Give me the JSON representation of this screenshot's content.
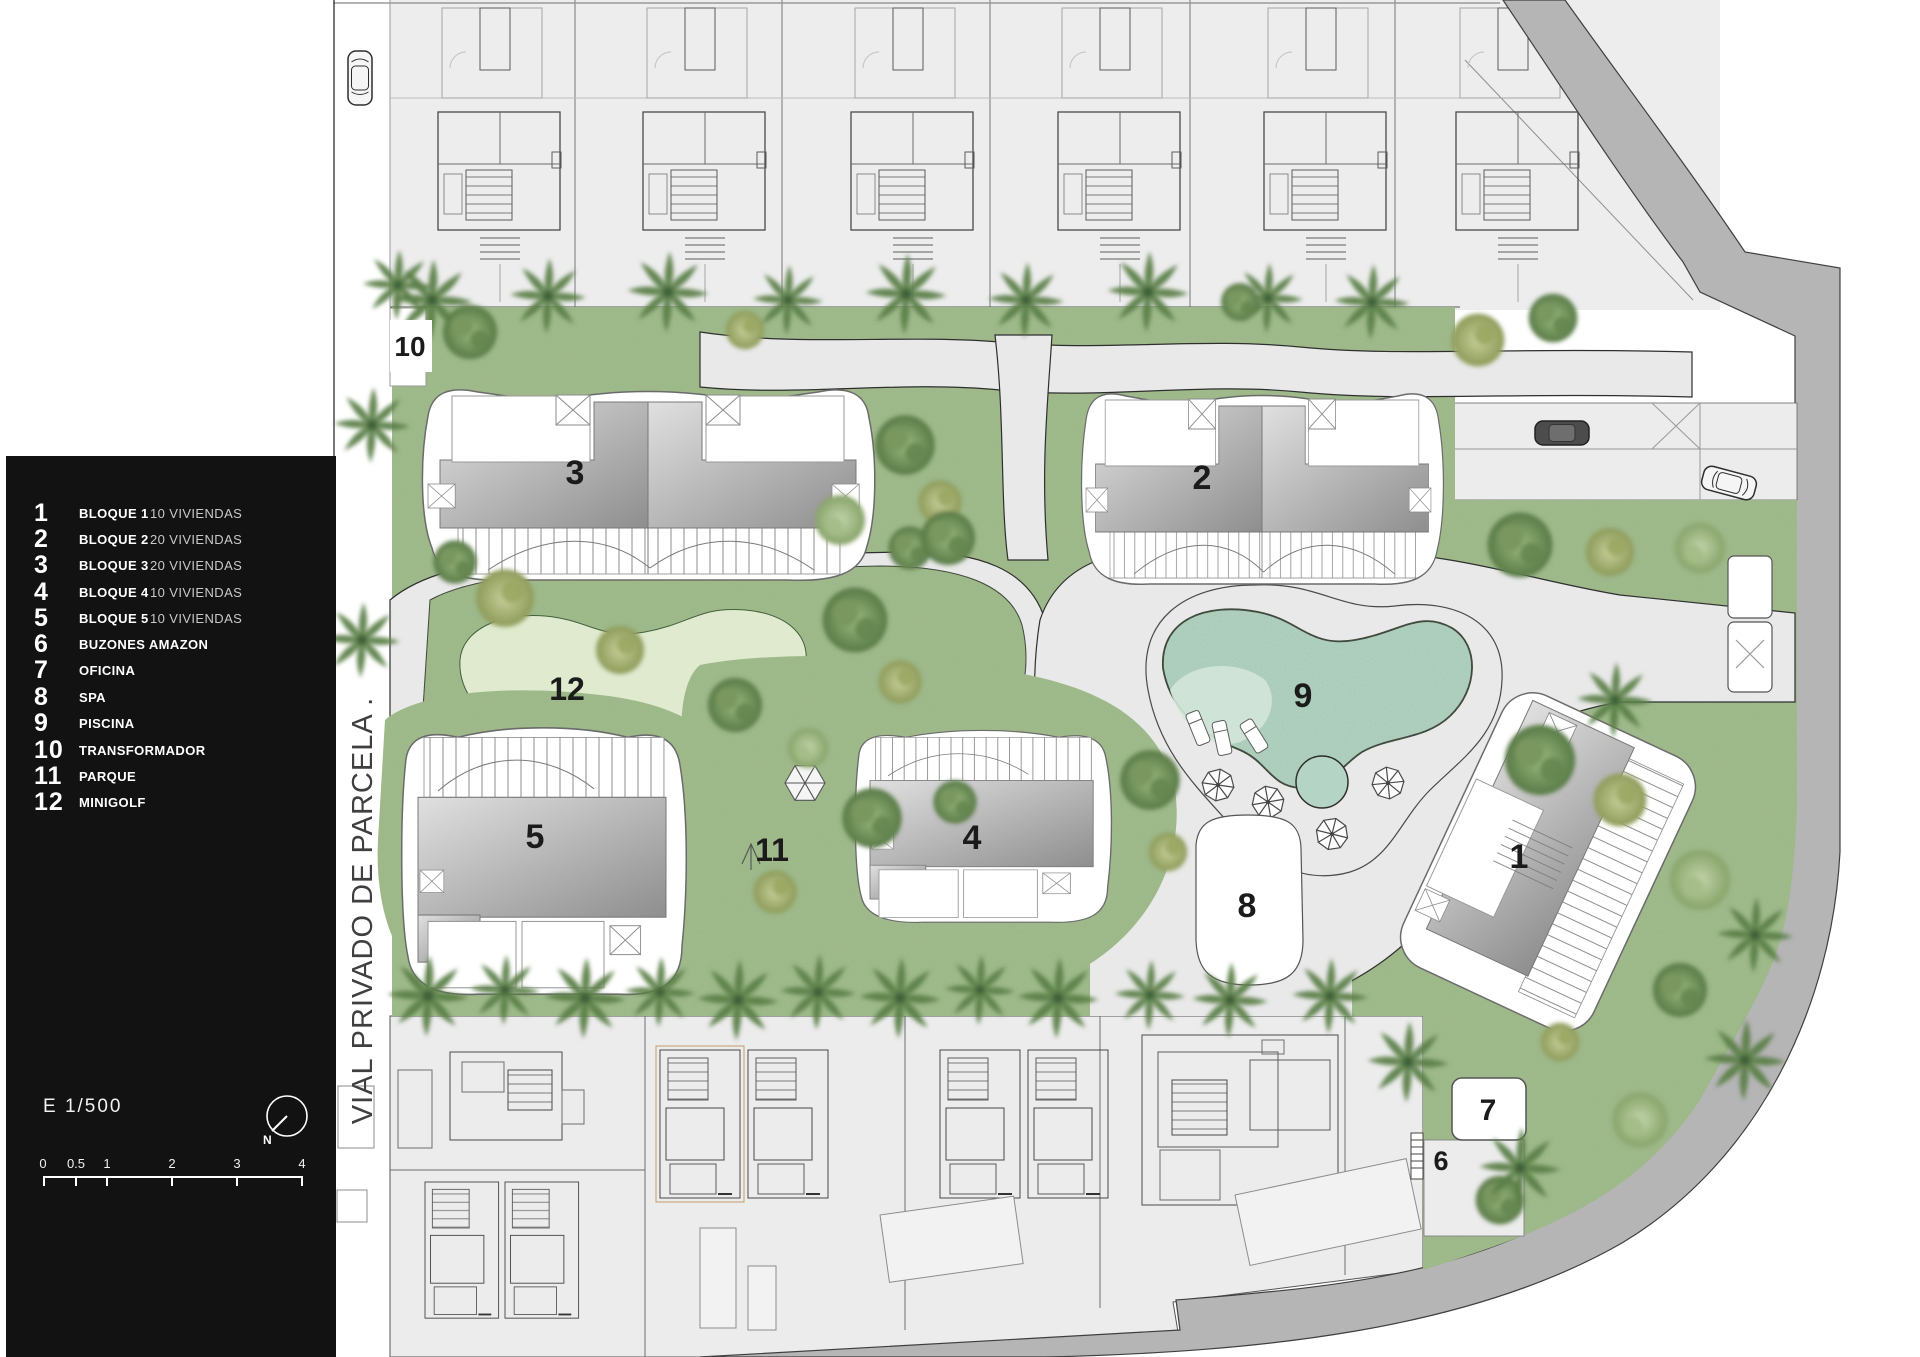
{
  "legend": {
    "items": [
      {
        "num": "1",
        "label": "BLOQUE 1",
        "detail": "10 VIVIENDAS"
      },
      {
        "num": "2",
        "label": "BLOQUE 2",
        "detail": "20 VIVIENDAS"
      },
      {
        "num": "3",
        "label": "BLOQUE 3",
        "detail": "20 VIVIENDAS"
      },
      {
        "num": "4",
        "label": "BLOQUE 4",
        "detail": "10 VIVIENDAS"
      },
      {
        "num": "5",
        "label": "BLOQUE 5",
        "detail": "10 VIVIENDAS"
      },
      {
        "num": "6",
        "label": "BUZONES AMAZON",
        "detail": ""
      },
      {
        "num": "7",
        "label": "OFICINA",
        "detail": ""
      },
      {
        "num": "8",
        "label": "SPA",
        "detail": ""
      },
      {
        "num": "9",
        "label": "PISCINA",
        "detail": ""
      },
      {
        "num": "10",
        "label": "TRANSFORMADOR",
        "detail": ""
      },
      {
        "num": "11",
        "label": "PARQUE",
        "detail": ""
      },
      {
        "num": "12",
        "label": "MINIGOLF",
        "detail": ""
      }
    ],
    "scale_label": "E 1/500",
    "north_label": "N",
    "scale_ticks": [
      "0",
      "0.5",
      "1",
      "2",
      "3",
      "4"
    ]
  },
  "plan": {
    "street_label": "VIAL PRIVADO DE PARCELA .",
    "labels": [
      {
        "id": "block-1",
        "text": "1"
      },
      {
        "id": "block-2",
        "text": "2"
      },
      {
        "id": "block-3",
        "text": "3"
      },
      {
        "id": "block-4",
        "text": "4"
      },
      {
        "id": "block-5",
        "text": "5"
      },
      {
        "id": "buzones",
        "text": "6"
      },
      {
        "id": "oficina",
        "text": "7"
      },
      {
        "id": "spa",
        "text": "8"
      },
      {
        "id": "piscina",
        "text": "9"
      },
      {
        "id": "transformador",
        "text": "10"
      },
      {
        "id": "parque",
        "text": "11"
      },
      {
        "id": "minigolf",
        "text": "12"
      }
    ]
  },
  "colors": {
    "panel": "#121212",
    "grass": "#a3bd8e",
    "water": "#b4d5c6",
    "road": "#b5b5b5",
    "path": "#e9e9e9",
    "minigolf_green": "#dfeacf",
    "lot": "#ededed",
    "roof_dark": "#8e8e8e"
  }
}
